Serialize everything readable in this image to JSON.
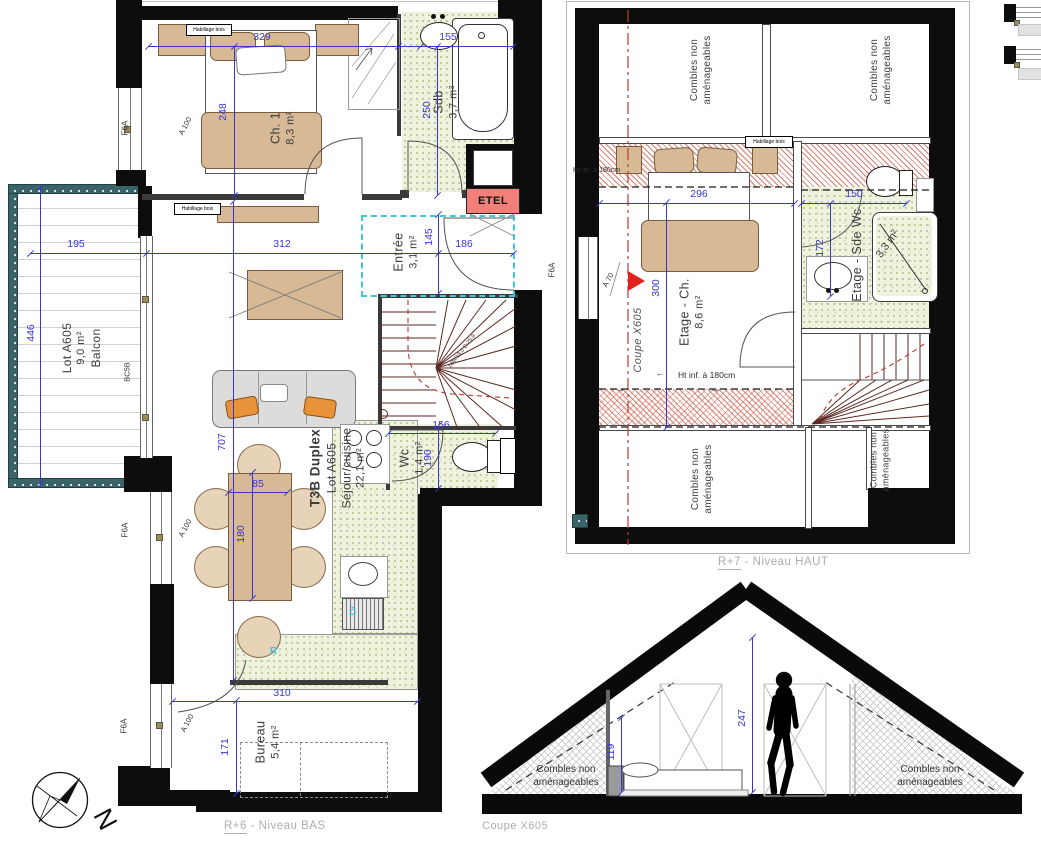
{
  "colors": {
    "dimension_blue": "#3a35cf",
    "wall_black": "#0d0d0d",
    "tile_green": "#eef2df",
    "hatch_red": "#cf5240",
    "accent_cyan": "#35c6da",
    "etel_red": "#f28079",
    "railing_teal": "#3a6468",
    "furniture_tan": "#d8b996",
    "caption_gray": "#a8aeb4"
  },
  "captions": {
    "bas_level": "R+6",
    "bas_suffix": "- Niveau BAS",
    "haut_level": "R+7",
    "haut_suffix": "- Niveau HAUT",
    "coupe": "Coupe X605"
  },
  "plan_bas": {
    "unit": {
      "type": "T3B Duplex",
      "lot": "Lot A605",
      "room": "Séjour/cuisine",
      "area": "22,1 m²"
    },
    "rooms": {
      "ch1": {
        "name": "Ch. 1",
        "area": "8,3 m²"
      },
      "sdb": {
        "name": "Sdb",
        "area": "3,7 m²"
      },
      "entree": {
        "name": "Entrée",
        "area": "3,1 m²"
      },
      "wc": {
        "name": "Wc",
        "area": "1,4 m²"
      },
      "bureau": {
        "name": "Bureau",
        "area": "5,4 m²"
      },
      "balcon": {
        "lot": "Lot A605",
        "area": "9,0 m²",
        "name": "Balcon"
      }
    },
    "dims": {
      "bedroom_w": "329",
      "bedroom_d": "248",
      "sdb_w": "155",
      "sdb_d": "250",
      "balcon_w": "195",
      "balcon_d": "446",
      "sejour_w": "312",
      "entree_w": "186",
      "entree_d": "145",
      "sejour_d": "707",
      "table_w": "85",
      "table_d": "180",
      "wc_w": "156",
      "wc_d": "190",
      "bureau_w": "310",
      "bureau_d": "171"
    },
    "tags": {
      "f6a": "F6A",
      "a100": "A 100",
      "bc5b": "BC5B",
      "habillage": "Habillage bois",
      "etel": "ETEL",
      "lv": "LV",
      "fridge": "R",
      "stair_note": "18M/18,0 G:25,8"
    }
  },
  "plan_haut": {
    "combles": "Combles non aménageables",
    "rooms": {
      "ch": {
        "name": "Etage - Ch.",
        "area": "8,6 m²"
      },
      "sdewc": {
        "name": "Etage - Sde Wc",
        "area": "3,3 m²"
      }
    },
    "dims": {
      "ch_w": "296",
      "sdewc_w": "150",
      "sdewc_d": "172",
      "ch_d": "300"
    },
    "notes": {
      "ht_inf": "Ht inf. à 180cm",
      "a70": "A 70",
      "arrow": "→"
    }
  },
  "section": {
    "combles": "Combles non aménageables",
    "dims": {
      "ceiling": "247",
      "knee": "119"
    }
  },
  "compass": {
    "north": "N"
  }
}
